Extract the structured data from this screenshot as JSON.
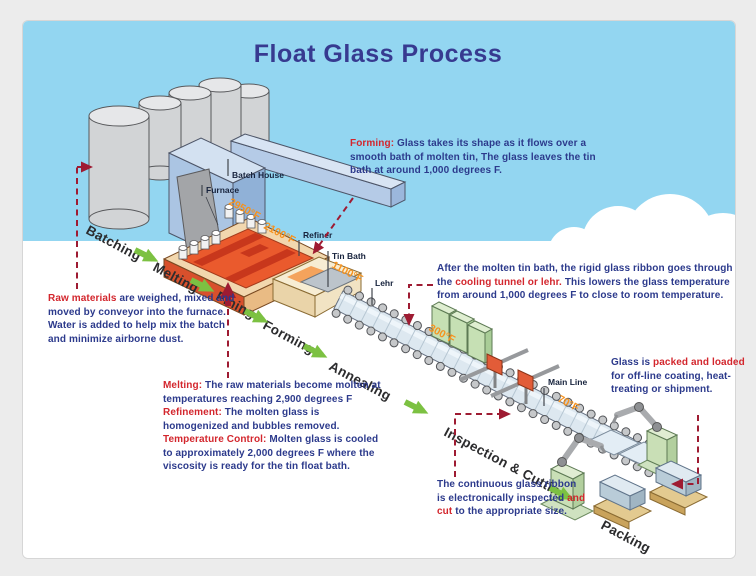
{
  "title": "Float Glass Process",
  "stages": {
    "batching": "Batching",
    "melting": "Melting",
    "fining": "Fining",
    "forming": "Forming",
    "annealing": "Annealing",
    "inspection": "Inspection & Cutting",
    "packing": "Packing"
  },
  "machine_labels": {
    "batch_house": "Batch House",
    "furnace": "Furnace",
    "refiner": "Refiner",
    "tin_bath": "Tin Bath",
    "lehr": "Lehr",
    "main_line": "Main Line"
  },
  "temperatures": {
    "furnace_melt": "2950°F",
    "furnace_exit": "2100°F",
    "tin_bath": "1100°F",
    "lehr_exit": "300°F",
    "main_line": "70°F"
  },
  "annotations": {
    "forming": {
      "lead": "Forming:",
      "body": " Glass takes its shape as it flows over a smooth bath of molten tin, The glass leaves the tin bath at around 1,000 degrees F."
    },
    "raw_materials": {
      "lead": "Raw materials",
      "body": " are weighed, mixed and moved by conveyor into the furnace. Water is added to help mix the batch and minimize airborne dust."
    },
    "melting_refinement": {
      "lead1": "Melting:",
      "body1": " The raw materials become molten at temperatures reaching 2,900 degrees F",
      "lead2": "Refinement:",
      "body2": " The molten glass is homogenized and bubbles removed.",
      "lead3": "Temperature Control:",
      "body3": " Molten glass is cooled to approximately 2,000 degrees F where the viscosity is ready for the tin float bath."
    },
    "cooling": {
      "body1": "After the molten tin bath, the rigid glass ribbon goes through the ",
      "lead": "cooling tunnel or lehr.",
      "body2": " This lowers the glass temperature from around 1,000 degrees F to close to room temperature."
    },
    "packing": {
      "body1": "Glass is ",
      "lead": "packed and loaded",
      "body2": " for off-line coating, heat-treating or shipment."
    },
    "inspection": {
      "body1": "The continuous glass ribbon is electronically inspected ",
      "lead": "and cut",
      "body2": " to the appropriate size."
    }
  },
  "colors": {
    "sky": "#93d6f1",
    "title_navy": "#373a90",
    "text_navy": "#2c3a8c",
    "text_red": "#d3262d",
    "pointer_red": "#9e1b32",
    "temp_orange": "#f6921e",
    "arrow_green": "#7cc142"
  }
}
